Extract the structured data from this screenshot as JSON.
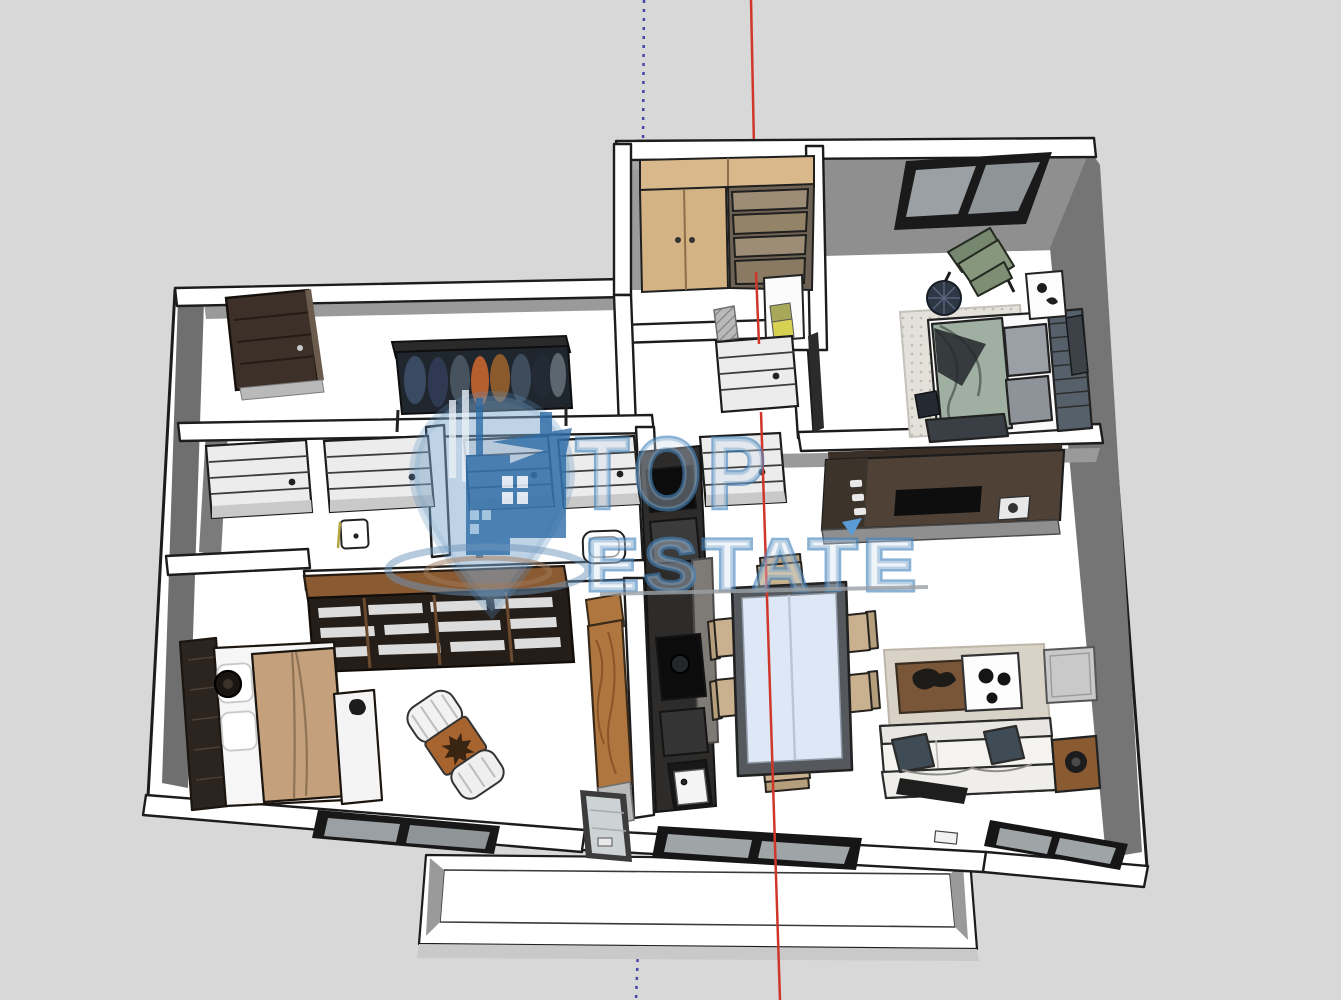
{
  "app": {
    "title": "3D apartment floor plan render",
    "view": "axonometric top-down"
  },
  "watermark": {
    "line1": "TOP",
    "line2": "ESTATE",
    "color": "#4484bd",
    "fill_tint": "#cfe0ef",
    "logo": "map-pin-with-buildings-icon"
  },
  "axes": {
    "red_axis_color": "#cf372b",
    "blue_axis_color": "#4545a5"
  },
  "palette": {
    "background": "#d8d8d8",
    "wall_white": "#ffffff",
    "outline": "#1c1c1c",
    "wall_inner_gray": "#757575",
    "wood_light": "#d9b98c",
    "wood_dark": "#8a5a33",
    "counter_brown": "#4f4136",
    "cabinet_dark": "#2e2c2a",
    "glass_blue": "#dde7f5",
    "chair_beige": "#c9b18f",
    "sofa_white": "#f4f3f0",
    "pillow_slate": "#3f4c55",
    "blanket_tan": "#c4a17c",
    "duvet_green": "#9fb0a2",
    "cushion_orange": "#a8642f",
    "rug_beige": "#d9d2c6",
    "window_glass": "#9aa0a3",
    "door_panel": "#ececec"
  },
  "scene": {
    "rooms": [
      {
        "name": "entry-hall",
        "furniture": [
          "front-door",
          "coat-rack-with-clothes"
        ]
      },
      {
        "name": "storage-room",
        "furniture": [
          "wardrobe-cabinet-doors",
          "drawer-unit"
        ]
      },
      {
        "name": "hallway",
        "furniture": [
          "interior-door-1",
          "interior-door-2",
          "interior-door-3",
          "interior-door-4",
          "interior-door-5",
          "bedroom-door",
          "shoe-cabinet",
          "hatch-mark"
        ]
      },
      {
        "name": "bedroom-top-right",
        "furniture": [
          "window",
          "double-bed-green",
          "headboard-slats",
          "green-armchair",
          "round-mat",
          "dotted-rug",
          "nightstand",
          "wall-tv",
          "floor-book"
        ]
      },
      {
        "name": "bathrooms",
        "furniture": [
          "toilet",
          "bathtub",
          "partition-wall"
        ]
      },
      {
        "name": "kitchen",
        "furniture": [
          "counter-with-cooktop-and-sink",
          "tall-cabinet-column",
          "oven",
          "kitchen-sink"
        ]
      },
      {
        "name": "dining-area",
        "furniture": [
          "glass-top-table",
          "chair-north",
          "chair-south",
          "chair-west-1",
          "chair-west-2",
          "chair-east-1",
          "chair-east-2"
        ]
      },
      {
        "name": "living-room",
        "furniture": [
          "sofa",
          "dark-cushions",
          "coffee-table-cowhide",
          "white-tray-table",
          "area-rug",
          "side-table",
          "media-cabinet-speaker",
          "window",
          "glass-door"
        ]
      },
      {
        "name": "bedroom-bottom-left",
        "furniture": [
          "double-bed-tan",
          "headboard-panel",
          "bedside-stool",
          "white-bench",
          "chaise-lounge-orange-cushion",
          "bookshelf",
          "wooden-wardrobe",
          "window"
        ]
      },
      {
        "name": "balcony",
        "furniture": [
          "parapet-wall"
        ]
      }
    ]
  }
}
